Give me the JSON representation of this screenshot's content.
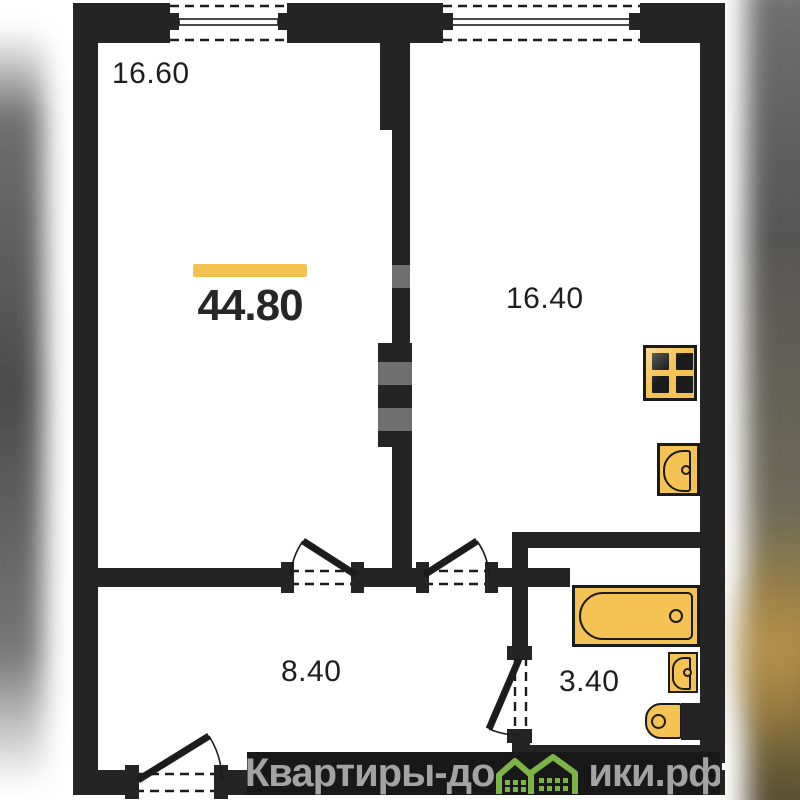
{
  "plan": {
    "type": "apartment-floor-plan",
    "total": {
      "value": "44.80"
    },
    "rooms": [
      {
        "name": "room-top-left",
        "area": "16.60"
      },
      {
        "name": "room-top-right",
        "area": "16.40"
      },
      {
        "name": "hallway",
        "area": "8.40"
      },
      {
        "name": "bathroom",
        "area": "3.40"
      }
    ]
  },
  "watermark": {
    "brand": "Квартиры-домики.рф",
    "prefix": "Квартиры-до",
    "suffix": "ики.рф",
    "houses_glyph": "two green houses replacing letter м"
  },
  "icons": {
    "stove": "stove-icon",
    "kitchen_sink": "kitchen-sink-icon",
    "bathtub": "bathtub-icon",
    "bathroom_sink": "bathroom-sink-icon",
    "toilet": "toilet-icon",
    "houses": "watermark-houses-icon"
  },
  "colors": {
    "wall": "#242424",
    "fixture-fill": "#f5c354",
    "fixture-stroke": "#1b1b1b",
    "highlight": "#f3c24e",
    "label": "#1e1e1e",
    "wm-bar": "#181818",
    "wm-text": "#a3a3a3",
    "wm-green": "#7cb445"
  }
}
